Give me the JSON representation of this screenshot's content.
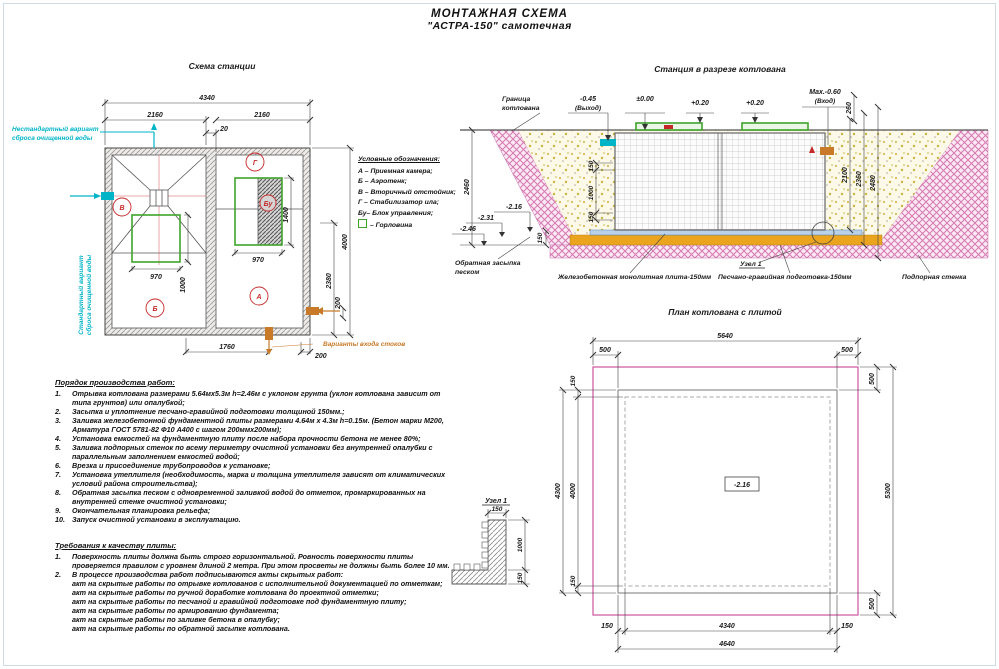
{
  "page_title": {
    "line1": "МОНТАЖНАЯ СХЕМА",
    "line2": "\"АСТРА-150\" самотечная"
  },
  "station_plan": {
    "title": "Схема станции",
    "compartments": {
      "v": "В",
      "b": "Б",
      "g": "Г",
      "a": "А",
      "bu": "Бу"
    },
    "dims": {
      "total_width": "4340",
      "left_width": "2160",
      "right_width": "2160",
      "gap": "20",
      "neck_left_w": "970",
      "neck_left_h": "1000",
      "neck_right_w": "970",
      "neck_right_h": "1400",
      "total_height": "4000",
      "inlet_height": "2380",
      "inlet_offset_side": "200",
      "inlet_span": "1760",
      "inlet_offset_bottom": "200"
    },
    "notes": {
      "nonstandard_line1": "Нестандартный вариант",
      "nonstandard_line2": "сброса очищенной воды",
      "standard_line1": "Стандартный вариант",
      "standard_line2": "сброса очищенной воды",
      "inlet_options": "Варианты входа стоков"
    }
  },
  "legend": {
    "title": "Условные обозначения:",
    "items": [
      "А – Приемная камера;",
      "Б – Аэротенк;",
      "В – Вторичный отстойник;",
      "Г – Стабилизатор ила;",
      "Бу– Блок управления;",
      "– Горловина"
    ]
  },
  "section_view": {
    "title": "Станция в разрезе котлована",
    "labels": {
      "pit_boundary_line1": "Граница",
      "pit_boundary_line2": "котлована",
      "backfill_line1": "Обратная засыпка",
      "backfill_line2": "песком",
      "slab": "Железобетонная монолитная плита-150мм",
      "node_ref": "Узел 1",
      "prep": "Песчано-гравийная подготовка-150мм",
      "retaining_wall": "Подпорная стенка"
    },
    "elevations": {
      "outlet_value": "-0.45",
      "outlet_note": "(Выход)",
      "zero": "±0.00",
      "lid1": "+0.20",
      "lid2": "+0.20",
      "inlet_value": "Max.-0.60",
      "inlet_note": "(Вход)",
      "bottom1": "-2.16",
      "bottom2": "-2.31",
      "bottom3": "-2.46"
    },
    "dims": {
      "d260": "260",
      "d2100": "2100",
      "d2360": "2360",
      "d2480": "2480",
      "d2460": "2460",
      "d150a": "150",
      "d1000": "1000",
      "d150b": "150",
      "d150c": "150"
    }
  },
  "pit_plan": {
    "title": "План котлована с плитой",
    "center_elevation": "-2.16",
    "dims": {
      "top_total": "5640",
      "top_left": "500",
      "top_right": "500",
      "right_top": "500",
      "right_total": "5300",
      "right_bottom": "500",
      "left_top": "150",
      "left_outer": "4300",
      "left_inner": "4000",
      "left_bottom": "150",
      "bottom_left": "150",
      "bottom_center": "4340",
      "bottom_right": "150",
      "bottom_total": "4640"
    }
  },
  "node_detail": {
    "title": "Узел 1",
    "dim_top": "150",
    "dim_side": "1000",
    "dim_bottom": "150"
  },
  "work_order": {
    "title": "Порядок производства работ:",
    "items": [
      {
        "n": "1.",
        "text": "Отрывка котлована размерами 5.64мx5.3м h=2.46м с уклоном грунта (уклон котлована зависит от типа грунтов) или опалубкой;"
      },
      {
        "n": "2.",
        "text": "Засыпка и уплотнение песчано-гравийной подготовки толщиной 150мм.;"
      },
      {
        "n": "3.",
        "text": "Заливка железобетонной фундаментной плиты размерами 4.64м х 4.3м h=0.15м. (Бетон марки М200, Арматура ГОСТ 5781-82 Ф10 А400 с шагом 200ммх200мм);"
      },
      {
        "n": "4.",
        "text": "Установка емкостей на фундаментную плиту после набора прочности бетона не менее 80%;"
      },
      {
        "n": "5.",
        "text": "Заливка подпорных стенок по всему периметру очистной установки без внутренней опалубки с параллельным заполнением емкостей водой;"
      },
      {
        "n": "6.",
        "text": "Врезка и присоединение трубопроводов к установке;"
      },
      {
        "n": "7.",
        "text": "Установка утеплителя (необходимость, марка и толщина утеплителя зависят от климатических условий района строительства);"
      },
      {
        "n": "8.",
        "text": "Обратная засыпка песком с одновременной заливкой водой до отметок, промаркированных на внутренней стенке очистной установки;"
      },
      {
        "n": "9.",
        "text": "Окончательная планировка рельефа;"
      },
      {
        "n": "10.",
        "text": "Запуск очистной установки в эксплуатацию."
      }
    ]
  },
  "quality": {
    "title": "Требования к качеству плиты:",
    "items": [
      {
        "n": "1.",
        "text": "Поверхность плиты должна быть строго горизонтальной. Ровность поверхности плиты проверяется правилом с уровнем длиной 2 метра. При этом просветы не должны быть более 10 мм."
      },
      {
        "n": "2.",
        "text": "В процессе производства работ подписываются акты скрытых работ:"
      }
    ],
    "acts": [
      "акт на скрытые работы по отрывке котлованов с исполнительной документацией по отметкам;",
      "акт на скрытые работы по ручной доработке котлована до проектной отметки;",
      "акт на скрытые работы по песчаной и гравийной подготовке под фундаментную плиту;",
      "акт на скрытые работы по армированию фундамента;",
      "акт на скрытые работы по заливке бетона в опалубку;",
      "акт на скрытые работы по обратной засыпке котлована."
    ]
  }
}
